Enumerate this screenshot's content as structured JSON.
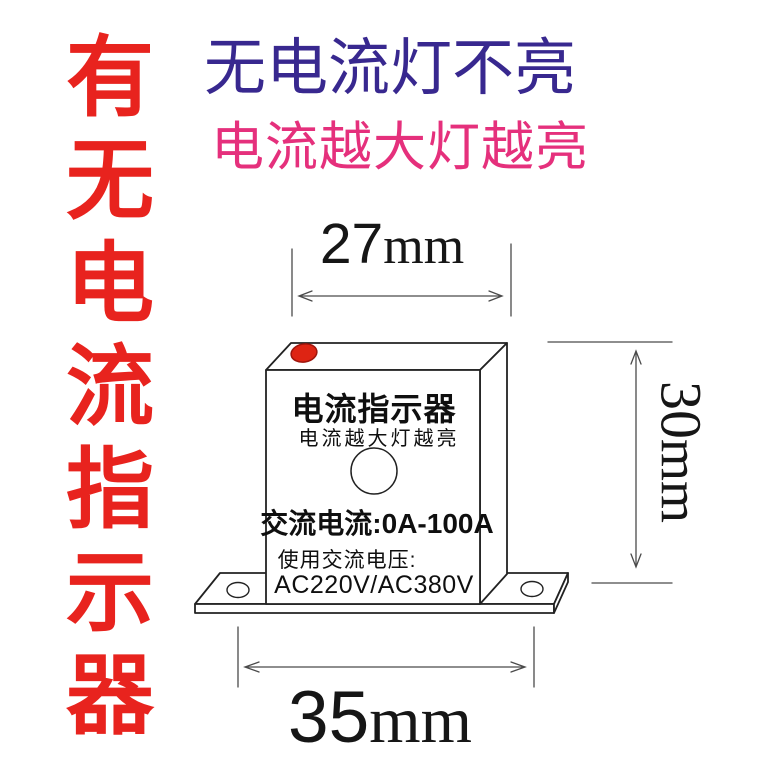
{
  "page": {
    "background": "#ffffff"
  },
  "left_slogan": {
    "text": "有无电流指示器",
    "chars": [
      "有",
      "无",
      "电",
      "流",
      "指",
      "示",
      "器"
    ],
    "color": "#e8231e"
  },
  "headlines": {
    "line1": {
      "text": "无电流灯不亮",
      "color": "#38288f"
    },
    "line2": {
      "text": "电流越大灯越亮",
      "color": "#e5307c"
    }
  },
  "dimensions": {
    "top_width": {
      "value": "27",
      "unit": "mm"
    },
    "side_height": {
      "value": "30",
      "unit": "mm"
    },
    "bottom_width": {
      "value": "35",
      "unit": "mm"
    }
  },
  "device": {
    "title": "电流指示器",
    "subtitle": "电流越大灯越亮",
    "spec_current": "交流电流:0A-100A",
    "spec_voltage_label": "使用交流电压:",
    "spec_voltage_value": "AC220V/AC380V",
    "led_color": "#de2413",
    "outline_color": "#222222",
    "dimension_line_color": "#4a4a4a"
  }
}
